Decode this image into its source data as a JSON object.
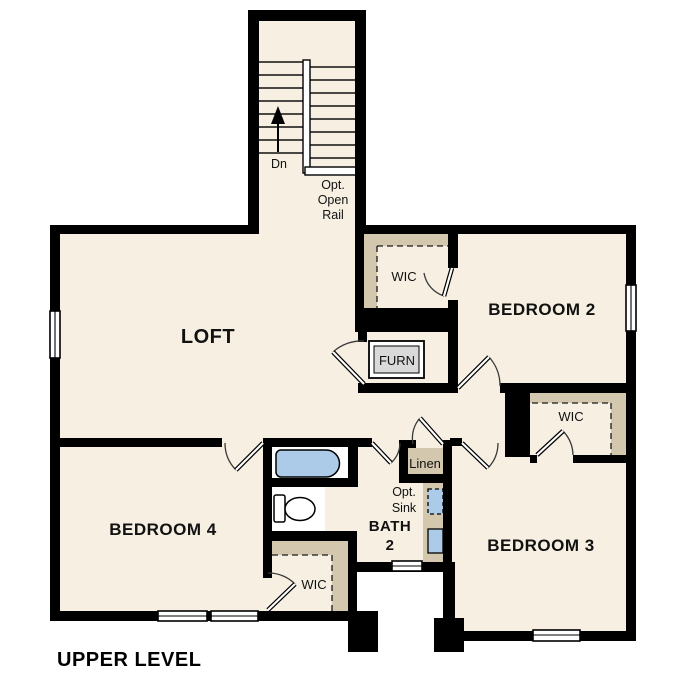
{
  "title": "UPPER LEVEL",
  "colors": {
    "floor": "#f6efe2",
    "shelf": "#d3c7ae",
    "fixture-blue": "#abcbe9",
    "furnace-gray": "#d9d9d9",
    "wall": "#000000",
    "paper": "#ffffff"
  },
  "rooms": {
    "loft": "LOFT",
    "bedroom2": "BEDROOM 2",
    "bedroom3": "BEDROOM 3",
    "bedroom4": "BEDROOM 4",
    "bath": {
      "line1": "BATH",
      "line2": "2"
    }
  },
  "closets": {
    "wic_bedroom2": "WIC",
    "wic_bedroom3": "WIC",
    "wic_bedroom4": "WIC",
    "linen": "Linen"
  },
  "stairs": {
    "down_label": "Dn",
    "rail_note": [
      "Opt.",
      "Open",
      "Rail"
    ]
  },
  "fixtures": {
    "furnace_label": "FURN",
    "optional_sink_note": [
      "Opt.",
      "Sink"
    ]
  }
}
